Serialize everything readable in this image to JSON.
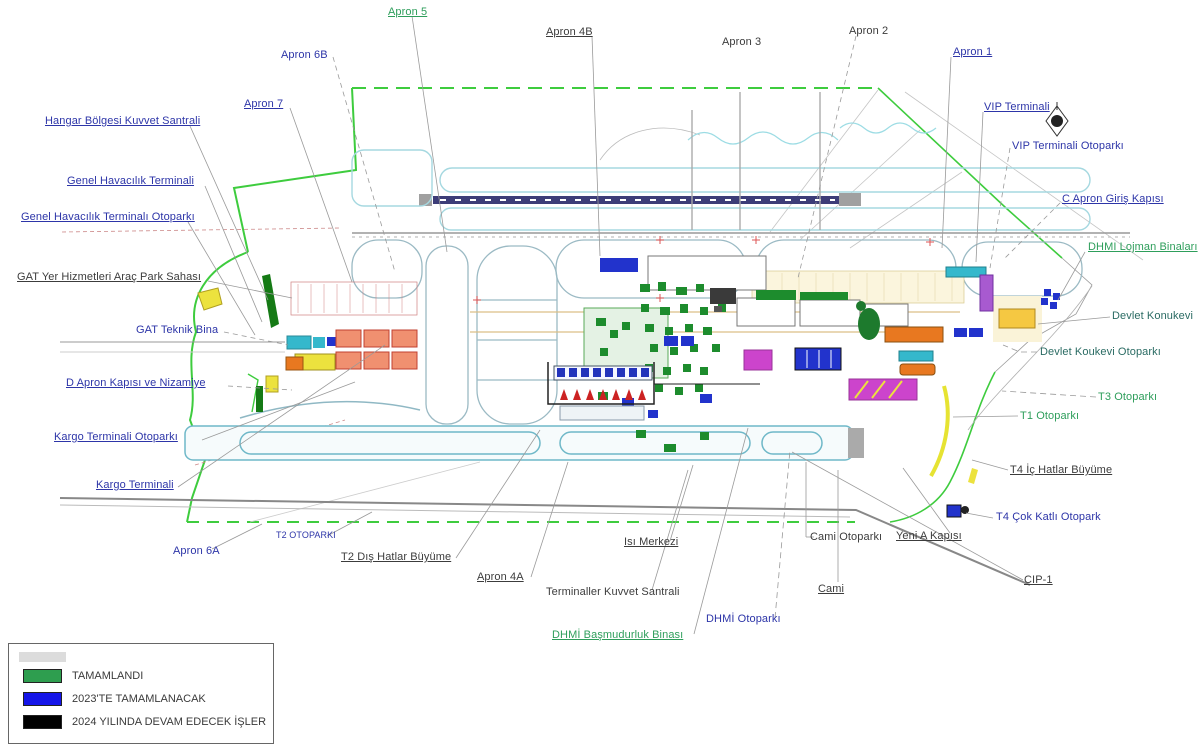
{
  "labels": {
    "apron5": "Apron 5",
    "apron6b": "Apron 6B",
    "apron4b": "Apron 4B",
    "apron3": "Apron 3",
    "apron2": "Apron 2",
    "apron1": "Apron 1",
    "apron7": "Apron 7",
    "hangar_bolgesi_kuvvet_santrali": "Hangar Bölgesi Kuvvet Santrali",
    "genel_havacilik_terminali": "Genel Havacılık Terminali",
    "genel_havacilik_terminali_otoparki": "Genel Havacılık Terminalı Otoparkı",
    "gat_yer_hizmetleri": "GAT Yer Hizmetleri Araç Park Sahası",
    "gat_teknik_bina": "GAT Teknik Bina",
    "d_apron_kapisi": "D Apron Kapısı ve Nizamiye",
    "kargo_terminali_otoparki": "Kargo Terminali Otoparkı",
    "kargo_terminali": "Kargo Terminali",
    "t2_otoparki": "T2 OTOPARKI",
    "apron6a": "Apron 6A",
    "t2_dis_hatlar_buyume": "T2 Dış Hatlar Büyüme",
    "apron4a": "Apron 4A",
    "terminaller_kuvvet_santrali": "Terminaller Kuvvet Santrali",
    "isi_merkezi": "Isı Merkezi",
    "dhmi_basmudurluk_binasi": "DHMİ Başmudurluk Binası",
    "dhmi_otoparki": "DHMİ Otoparkı",
    "cami": "Cami",
    "cami_otoparki": "Cami Otoparkı",
    "yeni_a_kapisi": "Yeni A Kapısı",
    "cip1": "CIP-1",
    "t4_cok_katli_otopark": "T4 Çok Katlı Otopark",
    "t4_ic_hatlar_buyume": "T4 İç Hatlar Büyüme",
    "t1_otoparki": "T1 Otoparkı",
    "t3_otoparki": "T3 Otoparkı",
    "devlet_koukevi_otoparki": "Devlet Koukevi Otoparkı",
    "devlet_konukevi": "Devlet Konukevi",
    "dhmi_lojman_binalari": "DHMI Lojman Binaları",
    "c_apron_giris_kapisi": "C Apron Giriş Kapısı",
    "vip_terminali_otoparki": "VIP Terminali Otoparkı",
    "vip_terminali": "VIP Terminali"
  },
  "legend": {
    "items": [
      {
        "label": "TAMAMLANDI",
        "color": "#2e9e4f"
      },
      {
        "label": "2023'TE TAMAMLANACAK",
        "color": "#1515e8"
      },
      {
        "label": "2024 YILINDA DEVAM EDECEK İŞLER",
        "color": "#000000"
      }
    ]
  },
  "colors": {
    "label_blue": "#2d35a8",
    "label_green": "#2e9e5b",
    "label_black": "#3c3c3c",
    "label_teal": "#2a6b63",
    "map_green": "#3ecc3e",
    "map_navy": "#3d3d78",
    "bld_green": "#1d8c2d",
    "bld_blue": "#2233cc",
    "bld_magenta": "#cc44cc",
    "bld_orange": "#e87820",
    "bld_salmon": "#f09070",
    "bld_yellow": "#ece23e",
    "bld_cyan": "#35b8cc",
    "taxi_cyan": "#a5d8e0",
    "runway2_teal": "#6fb8c8"
  }
}
